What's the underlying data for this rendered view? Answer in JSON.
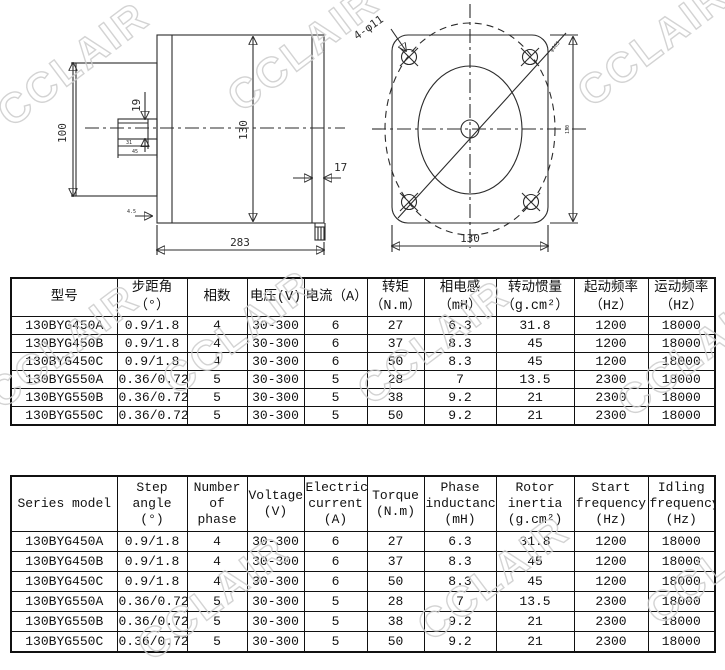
{
  "watermark": {
    "text": "CCLAIR",
    "color": "#cccccc",
    "positions": [
      {
        "x": -15,
        "y": 40
      },
      {
        "x": 215,
        "y": 25
      },
      {
        "x": 565,
        "y": 20
      },
      {
        "x": -25,
        "y": 322
      },
      {
        "x": 150,
        "y": 308
      },
      {
        "x": 345,
        "y": 318
      },
      {
        "x": 605,
        "y": 330
      },
      {
        "x": 125,
        "y": 574
      },
      {
        "x": 405,
        "y": 554
      },
      {
        "x": 633,
        "y": 538
      }
    ]
  },
  "drawing": {
    "side_view": {
      "rear_height": "100",
      "shaft_diameter": "19",
      "body_diameter": "130",
      "key_length": "31",
      "shaft_length": "45",
      "step": "4.5",
      "end_cap_width": "17",
      "total_length": "283"
    },
    "front_view": {
      "holes_label": "4-φ11",
      "flange_width": "130",
      "flange_height": "130",
      "bolt_circle": "φ165"
    }
  },
  "spec_table_cn": {
    "headers": [
      "型号",
      "步距角\n（°）",
      "相数",
      "电压(V)",
      "电流（A）",
      "转矩\n（N.m）",
      "相电感\n（mH）",
      "转动惯量\n（g.cm²）",
      "起动频率\n（Hz）",
      "运动频率\n（Hz）"
    ],
    "rows": [
      [
        "130BYG450A",
        "0.9/1.8",
        "4",
        "30-300",
        "6",
        "27",
        "6.3",
        "31.8",
        "1200",
        "18000"
      ],
      [
        "130BYG450B",
        "0.9/1.8",
        "4",
        "30-300",
        "6",
        "37",
        "8.3",
        "45",
        "1200",
        "18000"
      ],
      [
        "130BYG450C",
        "0.9/1.8",
        "4",
        "30-300",
        "6",
        "50",
        "8.3",
        "45",
        "1200",
        "18000"
      ],
      [
        "130BYG550A",
        "0.36/0.72",
        "5",
        "30-300",
        "5",
        "28",
        "7",
        "13.5",
        "2300",
        "18000"
      ],
      [
        "130BYG550B",
        "0.36/0.72",
        "5",
        "30-300",
        "5",
        "38",
        "9.2",
        "21",
        "2300",
        "18000"
      ],
      [
        "130BYG550C",
        "0.36/0.72",
        "5",
        "30-300",
        "5",
        "50",
        "9.2",
        "21",
        "2300",
        "18000"
      ]
    ]
  },
  "spec_table_en": {
    "headers": [
      "Series model",
      "Step\nangle\n(°)",
      "Number\nof phase",
      "Voltage\n(V)",
      "Electric\ncurrent\n(A)",
      "Torque\n(N.m)",
      "Phase\ninductance\n(mH)",
      "Rotor\ninertia\n(g.cm²)",
      "Start\nfrequency\n(Hz)",
      "Idling\nfrequency\n(Hz)"
    ],
    "rows": [
      [
        "130BYG450A",
        "0.9/1.8",
        "4",
        "30-300",
        "6",
        "27",
        "6.3",
        "31.8",
        "1200",
        "18000"
      ],
      [
        "130BYG450B",
        "0.9/1.8",
        "4",
        "30-300",
        "6",
        "37",
        "8.3",
        "45",
        "1200",
        "18000"
      ],
      [
        "130BYG450C",
        "0.9/1.8",
        "4",
        "30-300",
        "6",
        "50",
        "8.3",
        "45",
        "1200",
        "18000"
      ],
      [
        "130BYG550A",
        "0.36/0.72",
        "5",
        "30-300",
        "5",
        "28",
        "7",
        "13.5",
        "2300",
        "18000"
      ],
      [
        "130BYG550B",
        "0.36/0.72",
        "5",
        "30-300",
        "5",
        "38",
        "9.2",
        "21",
        "2300",
        "18000"
      ],
      [
        "130BYG550C",
        "0.36/0.72",
        "5",
        "30-300",
        "5",
        "50",
        "9.2",
        "21",
        "2300",
        "18000"
      ]
    ]
  }
}
